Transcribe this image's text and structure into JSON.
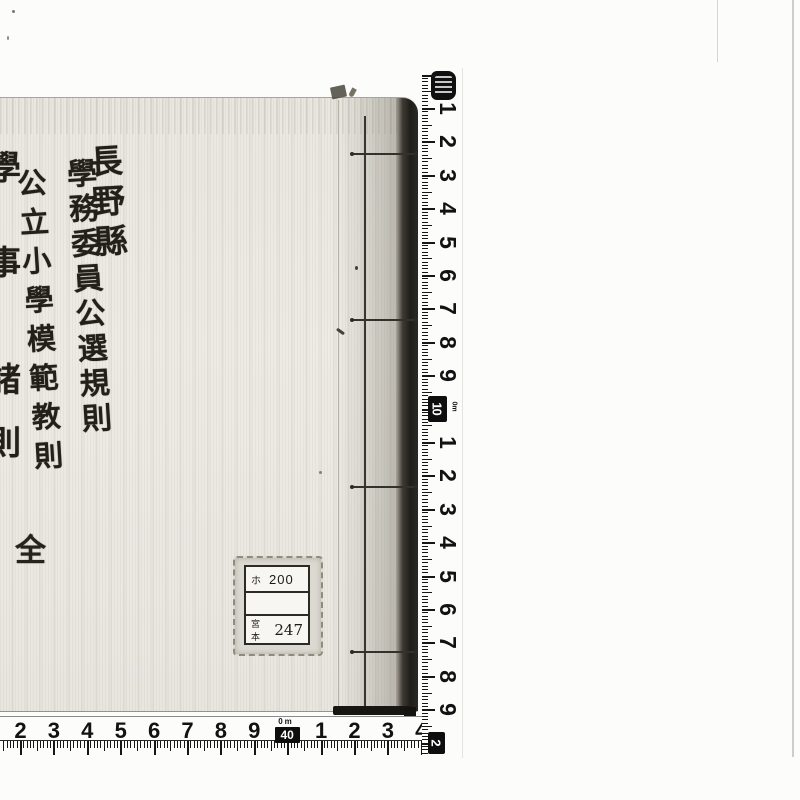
{
  "book": {
    "prefecture": "長野縣",
    "title": "學務委員公選規則",
    "subtitle": "公立小學模範教則",
    "edge_chars": [
      "學",
      "事",
      "諸",
      "則"
    ],
    "quantity_char": "全"
  },
  "label": {
    "row1_code": "ホ",
    "row1_number": "200",
    "row3_code": "宮本",
    "row3_number": "247"
  },
  "vertical_ruler": {
    "cm_labels": [
      "1",
      "2",
      "3",
      "4",
      "5",
      "6",
      "7",
      "8",
      "9"
    ],
    "decimeter_badge": {
      "value": "10",
      "unit": "0m"
    },
    "cm_labels_teens": [
      "1",
      "2",
      "3",
      "4",
      "5",
      "6",
      "7",
      "8",
      "9"
    ],
    "end_badge": {
      "value": "2"
    }
  },
  "horizontal_ruler": {
    "cm_labels_left": [
      "2",
      "3",
      "4",
      "5",
      "6",
      "7",
      "8",
      "9"
    ],
    "decimeter_badge": {
      "value": "40",
      "unit": "0m"
    },
    "cm_labels_right": [
      "1",
      "2",
      "3",
      "4"
    ]
  },
  "colors": {
    "cover": "#eceae3",
    "ink": "#23201a",
    "ruler_ink": "#141414",
    "spine_shadow": "#201e1a"
  }
}
